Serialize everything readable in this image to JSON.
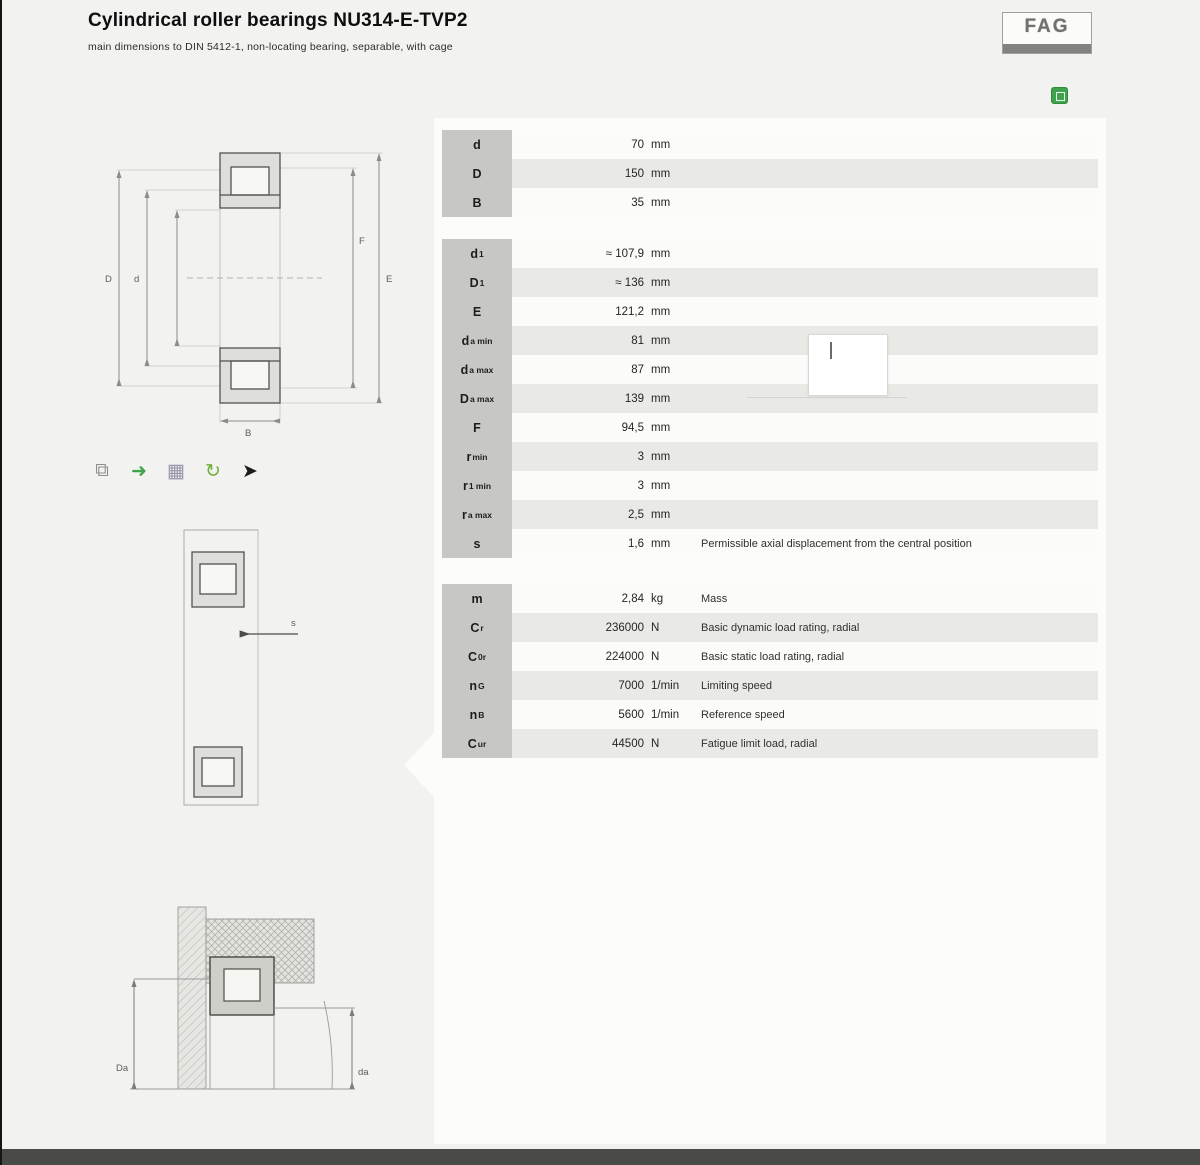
{
  "header": {
    "title": "Cylindrical roller bearings NU314-E-TVP2",
    "subtitle": "main dimensions to DIN 5412-1, non-locating bearing, separable, with cage",
    "logo_text": "FAG"
  },
  "toolbar_icons": [
    {
      "name": "bearing-preview-icon",
      "glyph": "⧉",
      "color": "#8f8f8c"
    },
    {
      "name": "cad-download-icon",
      "glyph": "➜",
      "color": "#3fa24d"
    },
    {
      "name": "table-icon",
      "glyph": "▦",
      "color": "#9090a8"
    },
    {
      "name": "rotate-3d-icon",
      "glyph": "↻",
      "color": "#6fae3a"
    },
    {
      "name": "pointer-icon",
      "glyph": "➤",
      "color": "#1c1c1c"
    }
  ],
  "drawings": {
    "main": {
      "left_outer": "D",
      "left_inner": "d",
      "right_outer": "E",
      "right_inner": "F",
      "bottom": "B"
    },
    "axial": {
      "arrow_label": "s"
    },
    "mounting": {
      "left": "Da",
      "right": "da"
    }
  },
  "table": {
    "sections": [
      {
        "name": "main-dimensions",
        "rows": [
          {
            "label": "d",
            "sub": "",
            "value": "70",
            "unit": "mm",
            "desc": ""
          },
          {
            "label": "D",
            "sub": "",
            "value": "150",
            "unit": "mm",
            "desc": ""
          },
          {
            "label": "B",
            "sub": "",
            "value": "35",
            "unit": "mm",
            "desc": ""
          }
        ]
      },
      {
        "name": "dimensions",
        "rows": [
          {
            "label": "d",
            "sub": "1",
            "value": "≈ 107,9",
            "unit": "mm",
            "desc": ""
          },
          {
            "label": "D",
            "sub": "1",
            "value": "≈ 136",
            "unit": "mm",
            "desc": ""
          },
          {
            "label": "E",
            "sub": "",
            "value": "121,2",
            "unit": "mm",
            "desc": ""
          },
          {
            "label": "d",
            "sub": "a min",
            "value": "81",
            "unit": "mm",
            "desc": ""
          },
          {
            "label": "d",
            "sub": "a max",
            "value": "87",
            "unit": "mm",
            "desc": ""
          },
          {
            "label": "D",
            "sub": "a max",
            "value": "139",
            "unit": "mm",
            "desc": ""
          },
          {
            "label": "F",
            "sub": "",
            "value": "94,5",
            "unit": "mm",
            "desc": ""
          },
          {
            "label": "r",
            "sub": "min",
            "value": "3",
            "unit": "mm",
            "desc": ""
          },
          {
            "label": "r",
            "sub": "1 min",
            "value": "3",
            "unit": "mm",
            "desc": ""
          },
          {
            "label": "r",
            "sub": "a max",
            "value": "2,5",
            "unit": "mm",
            "desc": ""
          },
          {
            "label": "s",
            "sub": "",
            "value": "1,6",
            "unit": "mm",
            "desc": "Permissible axial displacement from the central position"
          }
        ]
      },
      {
        "name": "performance-data",
        "rows": [
          {
            "label": "m",
            "sub": "",
            "value": "2,84",
            "unit": "kg",
            "desc": "Mass"
          },
          {
            "label": "C",
            "sub": "r",
            "value": "236000",
            "unit": "N",
            "desc": "Basic dynamic load rating, radial"
          },
          {
            "label": "C",
            "sub": "0r",
            "value": "224000",
            "unit": "N",
            "desc": "Basic static load rating, radial"
          },
          {
            "label": "n",
            "sub": "G",
            "value": "7000",
            "unit": "1/min",
            "desc": "Limiting speed"
          },
          {
            "label": "n",
            "sub": "B",
            "value": "5600",
            "unit": "1/min",
            "desc": "Reference speed"
          },
          {
            "label": "C",
            "sub": "ur",
            "value": "44500",
            "unit": "N",
            "desc": "Fatigue limit load, radial"
          }
        ]
      }
    ]
  },
  "tooltip": {
    "text": ""
  }
}
